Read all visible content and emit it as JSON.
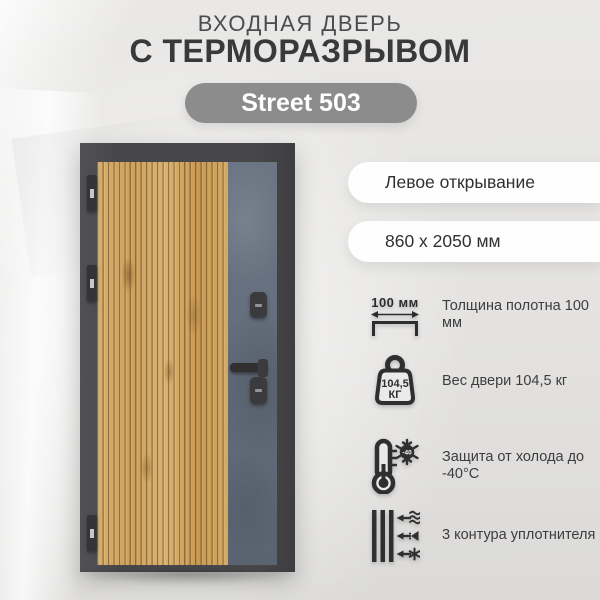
{
  "header": {
    "title_line1": "ВХОДНАЯ ДВЕРЬ",
    "title_line2": "С ТЕРМОРАЗРЫВОМ",
    "model": "Street 503"
  },
  "specs": {
    "opening": "Левое открывание",
    "dimensions": "860 х 2050 мм",
    "features": [
      {
        "icon": "thickness-icon",
        "icon_text": "100 мм",
        "label": "Толщина полотна 100 мм"
      },
      {
        "icon": "weight-icon",
        "icon_value": "104,5",
        "icon_unit": "КГ",
        "label": "Вес двери 104,5 кг"
      },
      {
        "icon": "frost-icon",
        "icon_text": "-40",
        "label": "Защита от холода до -40°C"
      },
      {
        "icon": "seals-icon",
        "label": "3 контура уплотнителя"
      }
    ]
  },
  "colors": {
    "badge_bg": "#8c8c8c",
    "badge_text": "#ffffff",
    "pill_bg": "#fefefe",
    "icon_ink": "#2f2f31",
    "frame": "#47474a",
    "wood": "#d2a763",
    "concrete": "#65707e"
  }
}
